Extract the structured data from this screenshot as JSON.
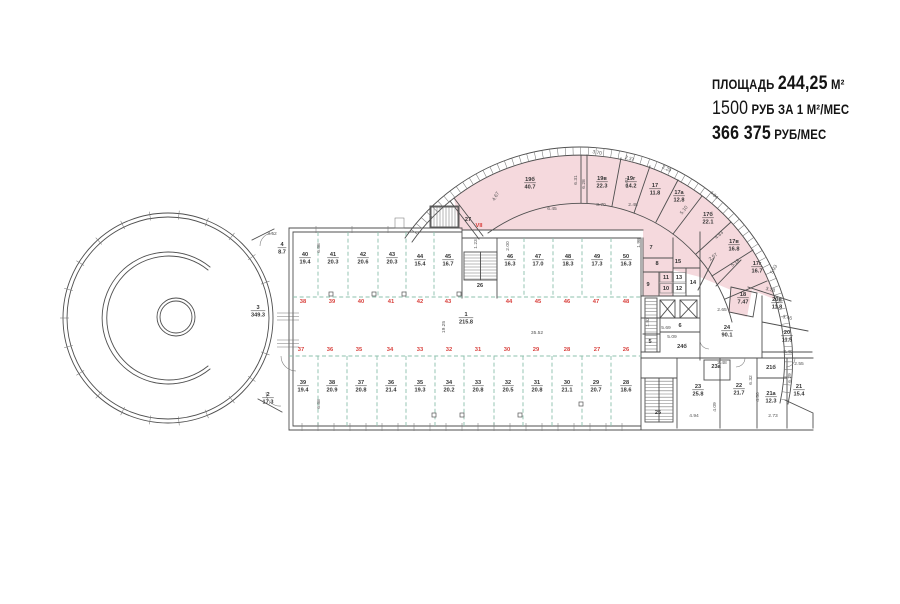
{
  "info_panel": {
    "line1_label": "ПЛОЩАДЬ",
    "line1_value": "244,25",
    "line1_unit": "М²",
    "line2_value": "1500",
    "line2_unit": "РУБ ЗА 1 М²/МЕС",
    "line3_value": "366 375",
    "line3_unit": "РУБ/МЕС"
  },
  "colors": {
    "highlight_pink": "#F5D9DD",
    "dashed_green": "#8CC0AC",
    "red_label": "#D9413D",
    "wall": "#4F4F4F",
    "text": "#333333"
  },
  "plan": {
    "rooms": [
      {
        "n": "4",
        "a": "8.7",
        "x": 282,
        "y": 246
      },
      {
        "n": "3",
        "a": "349.3",
        "x": 258,
        "y": 309
      },
      {
        "n": "2",
        "a": "17.3",
        "x": 268,
        "y": 396
      },
      {
        "n": "40",
        "a": "19.4",
        "x": 305,
        "y": 256
      },
      {
        "n": "41",
        "a": "20.3",
        "x": 333,
        "y": 256
      },
      {
        "n": "42",
        "a": "20.6",
        "x": 363,
        "y": 256
      },
      {
        "n": "43",
        "a": "20.3",
        "x": 392,
        "y": 256
      },
      {
        "n": "44",
        "a": "15.4",
        "x": 420,
        "y": 258
      },
      {
        "n": "45",
        "a": "16.7",
        "x": 448,
        "y": 258
      },
      {
        "n": "46",
        "a": "16.3",
        "x": 510,
        "y": 258
      },
      {
        "n": "47",
        "a": "17.0",
        "x": 538,
        "y": 258
      },
      {
        "n": "48",
        "a": "18.3",
        "x": 568,
        "y": 258
      },
      {
        "n": "49",
        "a": "17.3",
        "x": 597,
        "y": 258
      },
      {
        "n": "50",
        "a": "16.3",
        "x": 626,
        "y": 258
      },
      {
        "n": "1",
        "a": "215.8",
        "x": 466,
        "y": 316
      },
      {
        "n": "39",
        "a": "19.4",
        "x": 303,
        "y": 384
      },
      {
        "n": "38",
        "a": "20.9",
        "x": 332,
        "y": 384
      },
      {
        "n": "37",
        "a": "20.8",
        "x": 361,
        "y": 384
      },
      {
        "n": "36",
        "a": "21.4",
        "x": 391,
        "y": 384
      },
      {
        "n": "35",
        "a": "19.3",
        "x": 420,
        "y": 384
      },
      {
        "n": "34",
        "a": "20.2",
        "x": 449,
        "y": 384
      },
      {
        "n": "33",
        "a": "20.8",
        "x": 478,
        "y": 384
      },
      {
        "n": "32",
        "a": "20.5",
        "x": 508,
        "y": 384
      },
      {
        "n": "31",
        "a": "20.8",
        "x": 537,
        "y": 384
      },
      {
        "n": "30",
        "a": "21.1",
        "x": 567,
        "y": 384
      },
      {
        "n": "29",
        "a": "20.7",
        "x": 596,
        "y": 384
      },
      {
        "n": "28",
        "a": "18.6",
        "x": 626,
        "y": 384
      },
      {
        "n": "19б",
        "a": "40.7",
        "x": 530,
        "y": 181
      },
      {
        "n": "19в",
        "a": "22.3",
        "x": 602,
        "y": 180
      },
      {
        "n": "19г",
        "a": "14.2",
        "x": 631,
        "y": 180
      },
      {
        "n": "17",
        "a": "11.8",
        "x": 655,
        "y": 187
      },
      {
        "n": "17а",
        "a": "12.8",
        "x": 679,
        "y": 194
      },
      {
        "n": "17б",
        "a": "22.1",
        "x": 708,
        "y": 216
      },
      {
        "n": "17в",
        "a": "16.8",
        "x": 734,
        "y": 243
      },
      {
        "n": "17г",
        "a": "16.7",
        "x": 757,
        "y": 265
      },
      {
        "n": "18",
        "a": "7.47",
        "x": 743,
        "y": 296
      },
      {
        "n": "20в",
        "a": "11.8",
        "x": 777,
        "y": 301
      },
      {
        "n": "20",
        "a": "11.5",
        "x": 787,
        "y": 334
      },
      {
        "n": "24",
        "a": "90.1",
        "x": 727,
        "y": 329
      },
      {
        "n": "23",
        "a": "25.8",
        "x": 698,
        "y": 388
      },
      {
        "n": "22",
        "a": "21.7",
        "x": 739,
        "y": 387
      },
      {
        "n": "21а",
        "a": "12.3",
        "x": 771,
        "y": 395
      },
      {
        "n": "21",
        "a": "15.4",
        "x": 799,
        "y": 388
      },
      {
        "n": "27",
        "x": 468,
        "y": 221
      },
      {
        "n": "26",
        "x": 480,
        "y": 287
      },
      {
        "n": "25",
        "x": 658,
        "y": 414
      },
      {
        "n": "7",
        "x": 651,
        "y": 249
      },
      {
        "n": "8",
        "x": 657,
        "y": 265
      },
      {
        "n": "9",
        "x": 648,
        "y": 286
      },
      {
        "n": "11",
        "x": 666,
        "y": 279
      },
      {
        "n": "10",
        "x": 666,
        "y": 290
      },
      {
        "n": "13",
        "x": 679,
        "y": 279
      },
      {
        "n": "12",
        "x": 679,
        "y": 290
      },
      {
        "n": "14",
        "x": 693,
        "y": 284
      },
      {
        "n": "15",
        "x": 678,
        "y": 263
      },
      {
        "n": "5",
        "x": 650,
        "y": 343
      },
      {
        "n": "6",
        "x": 680,
        "y": 327
      },
      {
        "n": "23а",
        "x": 716,
        "y": 368
      },
      {
        "n": "21б",
        "x": 771,
        "y": 369
      },
      {
        "n": "24б",
        "x": 682,
        "y": 348
      }
    ],
    "red_numbers": [
      {
        "t": "38",
        "x": 303,
        "y": 303
      },
      {
        "t": "39",
        "x": 332,
        "y": 303
      },
      {
        "t": "40",
        "x": 361,
        "y": 303
      },
      {
        "t": "41",
        "x": 391,
        "y": 303
      },
      {
        "t": "42",
        "x": 420,
        "y": 303
      },
      {
        "t": "43",
        "x": 448,
        "y": 303
      },
      {
        "t": "44",
        "x": 509,
        "y": 303
      },
      {
        "t": "45",
        "x": 538,
        "y": 303
      },
      {
        "t": "46",
        "x": 567,
        "y": 303
      },
      {
        "t": "47",
        "x": 596,
        "y": 303
      },
      {
        "t": "48",
        "x": 626,
        "y": 303
      },
      {
        "t": "37",
        "x": 301,
        "y": 351
      },
      {
        "t": "36",
        "x": 330,
        "y": 351
      },
      {
        "t": "35",
        "x": 359,
        "y": 351
      },
      {
        "t": "34",
        "x": 390,
        "y": 351
      },
      {
        "t": "33",
        "x": 420,
        "y": 351
      },
      {
        "t": "32",
        "x": 449,
        "y": 351
      },
      {
        "t": "31",
        "x": 478,
        "y": 351
      },
      {
        "t": "30",
        "x": 507,
        "y": 351
      },
      {
        "t": "29",
        "x": 536,
        "y": 351
      },
      {
        "t": "28",
        "x": 567,
        "y": 351
      },
      {
        "t": "27",
        "x": 597,
        "y": 351
      },
      {
        "t": "26",
        "x": 626,
        "y": 351
      },
      {
        "t": "VII",
        "x": 479,
        "y": 227
      }
    ],
    "dimensions": [
      {
        "t": "3.52",
        "x": 272,
        "y": 235,
        "r": 0
      },
      {
        "t": "6.88",
        "x": 320,
        "y": 248,
        "r": -90
      },
      {
        "t": "6.88",
        "x": 320,
        "y": 404,
        "r": -90
      },
      {
        "t": "19.25",
        "x": 445,
        "y": 327,
        "r": -90
      },
      {
        "t": "35.52",
        "x": 537,
        "y": 334,
        "r": 0
      },
      {
        "t": "1.23",
        "x": 477,
        "y": 244,
        "r": -90
      },
      {
        "t": "2.00",
        "x": 509,
        "y": 246,
        "r": -90
      },
      {
        "t": "1.98",
        "x": 640,
        "y": 243,
        "r": -90
      },
      {
        "t": "4.67",
        "x": 497,
        "y": 197,
        "r": -60
      },
      {
        "t": "6.45",
        "x": 552,
        "y": 210,
        "r": 0
      },
      {
        "t": "3.70",
        "x": 601,
        "y": 206,
        "r": 0
      },
      {
        "t": "2.48",
        "x": 633,
        "y": 206,
        "r": 0
      },
      {
        "t": "6.31",
        "x": 577,
        "y": 180,
        "r": -90
      },
      {
        "t": "6.28",
        "x": 585,
        "y": 184,
        "r": -90
      },
      {
        "t": "6.01",
        "x": 628,
        "y": 182,
        "r": -90
      },
      {
        "t": "3.70",
        "x": 597,
        "y": 154,
        "r": 10
      },
      {
        "t": "2.37",
        "x": 629,
        "y": 160,
        "r": 18
      },
      {
        "t": "2.29",
        "x": 666,
        "y": 170,
        "r": 27
      },
      {
        "t": "5.10",
        "x": 685,
        "y": 211,
        "r": -52
      },
      {
        "t": "4.84",
        "x": 713,
        "y": 196,
        "r": 44
      },
      {
        "t": "4.83",
        "x": 720,
        "y": 236,
        "r": -42
      },
      {
        "t": "2.57",
        "x": 714,
        "y": 258,
        "r": -38
      },
      {
        "t": "5.18",
        "x": 736,
        "y": 264,
        "r": -38
      },
      {
        "t": "5.93",
        "x": 775,
        "y": 270,
        "r": -60
      },
      {
        "t": "3.28",
        "x": 770,
        "y": 291,
        "r": 14
      },
      {
        "t": "2.65",
        "x": 722,
        "y": 311,
        "r": 0
      },
      {
        "t": "3.46",
        "x": 787,
        "y": 319,
        "r": 12
      },
      {
        "t": "3.40",
        "x": 788,
        "y": 353,
        "r": 0
      },
      {
        "t": "2.48",
        "x": 722,
        "y": 364,
        "r": 0
      },
      {
        "t": "2.55",
        "x": 799,
        "y": 365,
        "r": 0
      },
      {
        "t": "1.83",
        "x": 649,
        "y": 322,
        "r": -90
      },
      {
        "t": "5.69",
        "x": 666,
        "y": 329,
        "r": 0
      },
      {
        "t": "5.09",
        "x": 672,
        "y": 338,
        "r": 0
      },
      {
        "t": "6.32",
        "x": 752,
        "y": 380,
        "r": -90
      },
      {
        "t": "4.50",
        "x": 759,
        "y": 397,
        "r": -90
      },
      {
        "t": "6.29",
        "x": 791,
        "y": 378,
        "r": -90
      },
      {
        "t": "4.09",
        "x": 716,
        "y": 407,
        "r": -90
      },
      {
        "t": "4.94",
        "x": 694,
        "y": 417,
        "r": 0
      },
      {
        "t": "2.73",
        "x": 773,
        "y": 417,
        "r": 0
      }
    ],
    "door_squares": [
      [
        374,
        294
      ],
      [
        404,
        294
      ],
      [
        459,
        294
      ],
      [
        331,
        294
      ],
      [
        520,
        415
      ],
      [
        462,
        415
      ],
      [
        581,
        404
      ],
      [
        434,
        415
      ]
    ]
  }
}
